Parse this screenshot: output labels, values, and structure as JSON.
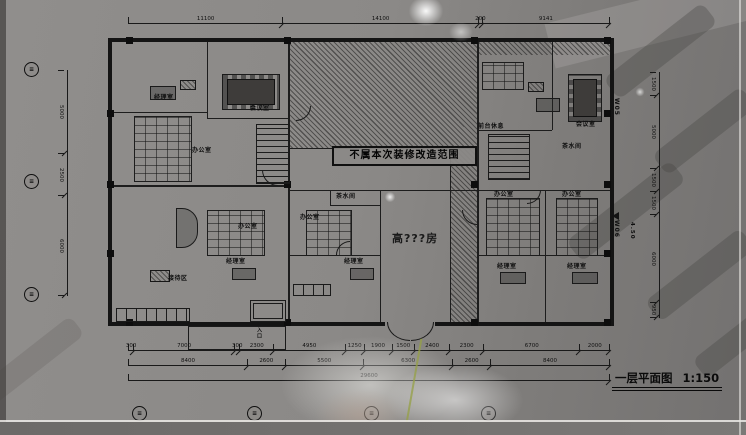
{
  "banner": {
    "text": "不属本次装修改造范围"
  },
  "titleblock": {
    "title": "一层平面图",
    "scale": "1:150"
  },
  "big_room": {
    "label": "高???房"
  },
  "entrance": {
    "label": "入口"
  },
  "elevation": {
    "label": "4.50"
  },
  "windows": {
    "w05": "W05",
    "w06": "W06"
  },
  "rooms": [
    {
      "label": "经理室"
    },
    {
      "label": "办公室"
    },
    {
      "label": "会议室"
    },
    {
      "label": "办公室"
    },
    {
      "label": "办公室"
    },
    {
      "label": "经理室"
    },
    {
      "label": "接待区"
    },
    {
      "label": "茶水间"
    },
    {
      "label": "经理室"
    },
    {
      "label": "前台休息"
    },
    {
      "label": "会议室"
    },
    {
      "label": "茶水间"
    },
    {
      "label": "办公室"
    },
    {
      "label": "办公室"
    },
    {
      "label": "经理室"
    },
    {
      "label": "经理室"
    }
  ],
  "dimensions": {
    "top": [
      "11100",
      "14100",
      "200",
      "9141"
    ],
    "bottom_row1": [
      "300",
      "7000",
      "300",
      "2300",
      "4950",
      "1250",
      "1900",
      "1500",
      "2400",
      "2300",
      "6700",
      "2000"
    ],
    "bottom_row2": [
      "8400",
      "2600",
      "5500",
      "6300",
      "2600",
      "8400"
    ],
    "bottom_total": [
      "29600"
    ],
    "left": [
      "5000",
      "2500",
      "6000"
    ],
    "right": [
      "1500",
      "5000",
      "1500",
      "1500",
      "6000",
      "950"
    ]
  },
  "axis": {
    "left": [
      "≡",
      "≡",
      "≡"
    ],
    "bottom": [
      "≡",
      "≡",
      "≡",
      "≡"
    ]
  },
  "colors": {
    "paper": "#8a8886",
    "ink": "#161616",
    "accent_green": "#96a046"
  }
}
